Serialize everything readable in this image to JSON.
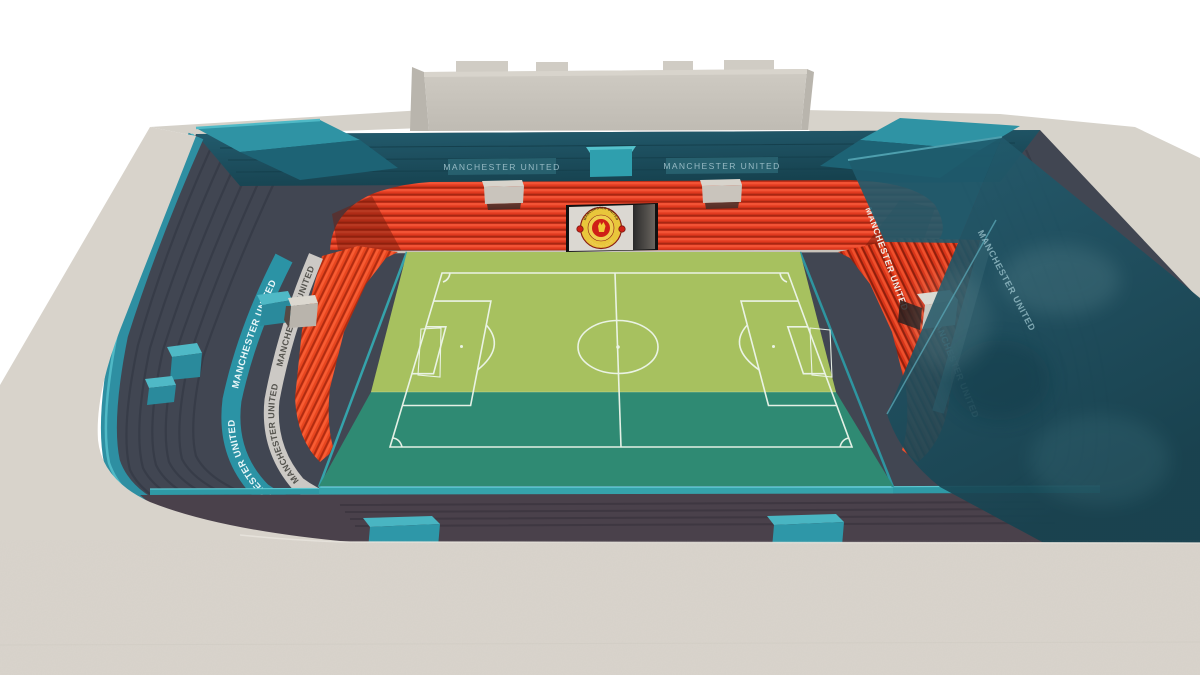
{
  "scene": {
    "club": "Manchester United",
    "subject": "3D stadium concept model render",
    "view": "elevated three-quarter view over near stand roof"
  },
  "texts": {
    "signs": {
      "far_left": "MANCHESTER UNITED",
      "far_right": "MANCHESTER UNITED"
    },
    "left_stand": {
      "teal_band_upper": "MANCHESTER UNITED",
      "teal_band_lower": "MANCHESTER UNITED",
      "walkway_upper": "MANCHESTER UNITED",
      "walkway_lower": "MANCHESTER UNITED"
    },
    "right_stand": {
      "band_upper": "MANCHESTER UNITED",
      "band_lower": "MANCHESTER UNITED",
      "glass_band": "MANCHESTER UNITED"
    },
    "crest": {
      "top": "MANCHESTER UNITED",
      "bottom": "FOOTBALL CLUB"
    }
  },
  "colors": {
    "background": "#ffffff",
    "concrete": "#d7d2ca",
    "screen_wall": "#c9c5bd",
    "glass_dark": "#1d4f5f",
    "glass_mid": "#2a6b7c",
    "teal": "#2f98a8",
    "teal_bright": "#4fb9c6",
    "teal_dark": "#1d6b7a",
    "upper_tier_slate": "#3f4450",
    "red_seats": "#e13a1f",
    "red_seats_bright": "#f25335",
    "red_seats_dark": "#a82712",
    "pitch_sunlit": "#a7c15f",
    "pitch_shaded": "#2f8a73",
    "pitch_lines": "#eef6ec",
    "walkway_light": "#ccc9c5",
    "near_concourse": "#4a414b",
    "crest_gold": "#e9c63b",
    "crest_red": "#cf2016"
  }
}
